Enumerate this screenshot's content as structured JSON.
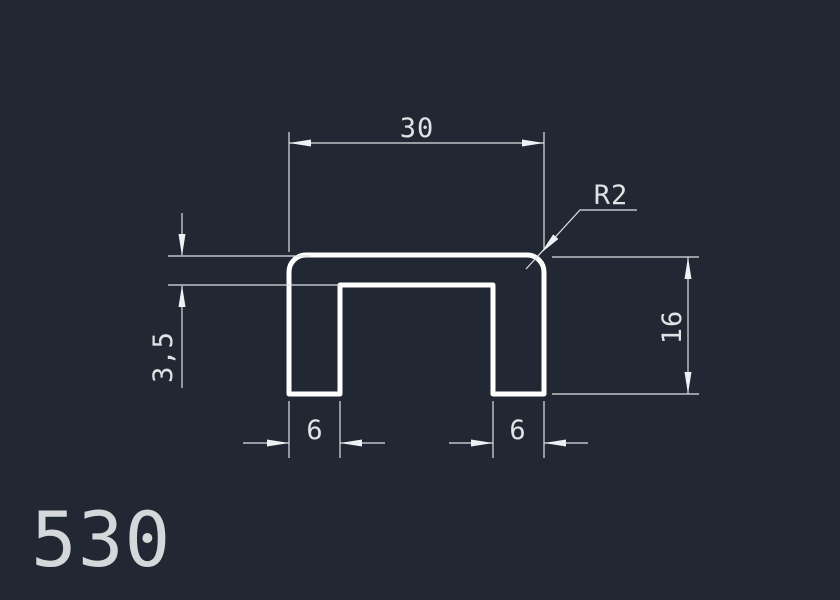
{
  "canvas": {
    "background_color": "#222833",
    "geometry_color": "#ffffff",
    "dimension_color": "#dde1e5"
  },
  "drawing": {
    "type": "U-channel profile cross-section",
    "part_number": "530",
    "dimensions": {
      "overall_width": "30",
      "corner_radius": "R2",
      "wall_thickness": "3,5",
      "height": "16",
      "left_flange": "6",
      "right_flange": "6"
    }
  }
}
